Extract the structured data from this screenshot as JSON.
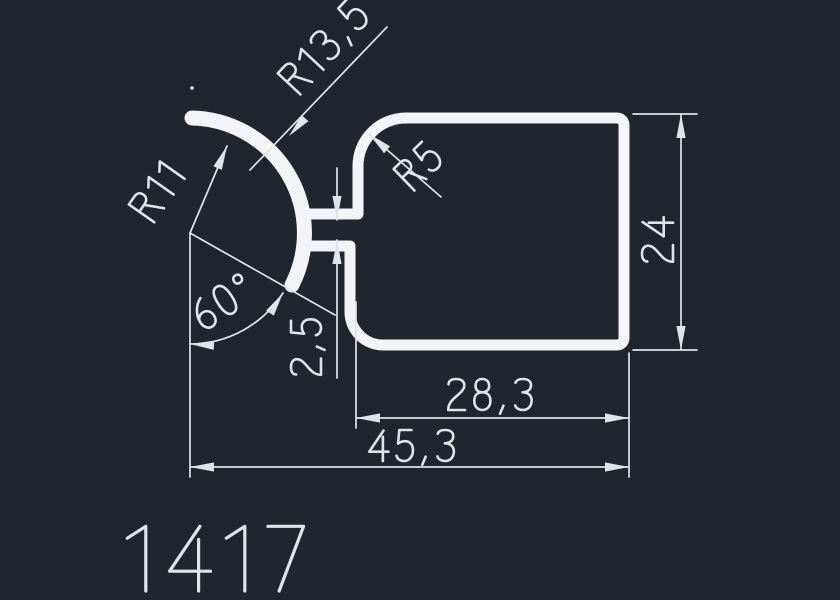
{
  "drawing": {
    "part_number": "1417",
    "labels": {
      "outer_radius": "R13,5",
      "inner_radius": "R11",
      "corner_radius": "R5",
      "angle": "60°",
      "slot_gap": "2,5",
      "height": "24",
      "inner_width": "28,3",
      "total_width": "45,3"
    },
    "colors": {
      "background": "#20252e",
      "profile": "#f2f4f7",
      "dimensions": "#dfe3ea"
    }
  }
}
